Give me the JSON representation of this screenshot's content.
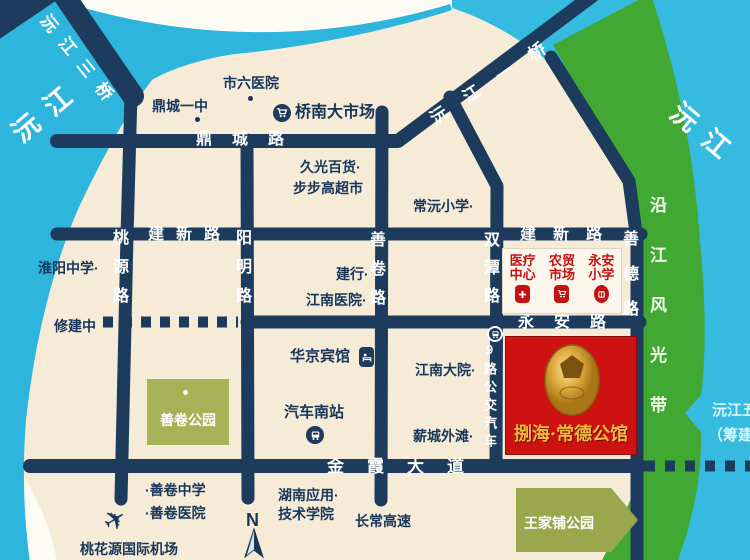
{
  "map": {
    "rivers": {
      "left_name": "沅江",
      "right_name": "沅江",
      "greenbelt": "沿江风光带",
      "planned_line1": "沅江五",
      "planned_line2": "（筹建"
    },
    "bridges": {
      "third": "沅江三桥",
      "first": "沅江一桥"
    },
    "roads": {
      "dingcheng": "鼎城路",
      "jianxin": "建新路",
      "taoyuan": "桃源路",
      "yangming": "阳明路",
      "shanjuan": "善卷路",
      "shuangtan": "双潭路",
      "shande": "善德路",
      "yongan": "永安路",
      "jinxia": "金霞大道",
      "under_construction": "修建中",
      "bus_route": "9路公交汽车"
    },
    "pois": [
      {
        "label": "市六医院"
      },
      {
        "label": "鼎城一中"
      },
      {
        "label": "桥南大市场"
      },
      {
        "label": "久光百货·"
      },
      {
        "label": "步步高超市"
      },
      {
        "label": "常沅小学·"
      },
      {
        "label": "淮阳中学·"
      },
      {
        "label": "建行·"
      },
      {
        "label": "江南医院·"
      },
      {
        "label": "华京宾馆"
      },
      {
        "label": "江南大院·"
      },
      {
        "label": "汽车南站"
      },
      {
        "label": "薪城外滩·"
      },
      {
        "label": "·善卷中学"
      },
      {
        "label": "·善卷医院"
      },
      {
        "label": "湖南应用·"
      },
      {
        "label": "技术学院"
      },
      {
        "label": "长常高速"
      },
      {
        "label": "桃花源国际机场"
      }
    ],
    "parks": {
      "shanjuan_park": "善卷公园",
      "wangjiapu_park": "王家铺公园"
    },
    "project": {
      "name": "捌海·常德公馆"
    },
    "info_box": {
      "items": [
        {
          "line1": "医疗",
          "line2": "中心"
        },
        {
          "line1": "农贸",
          "line2": "市场"
        },
        {
          "line1": "永安",
          "line2": "小学"
        }
      ]
    },
    "compass": "N",
    "colors": {
      "water": "#2db5dd",
      "water_right": "#35bbe0",
      "road": "#1d3b5c",
      "island": "#f6ebd7",
      "greenbelt": "#41a834",
      "park": "#a7b156",
      "project_red": "#ce1111",
      "project_gold": "#edb93f",
      "poi_text": "#17365a",
      "info_red": "#c41212"
    }
  }
}
